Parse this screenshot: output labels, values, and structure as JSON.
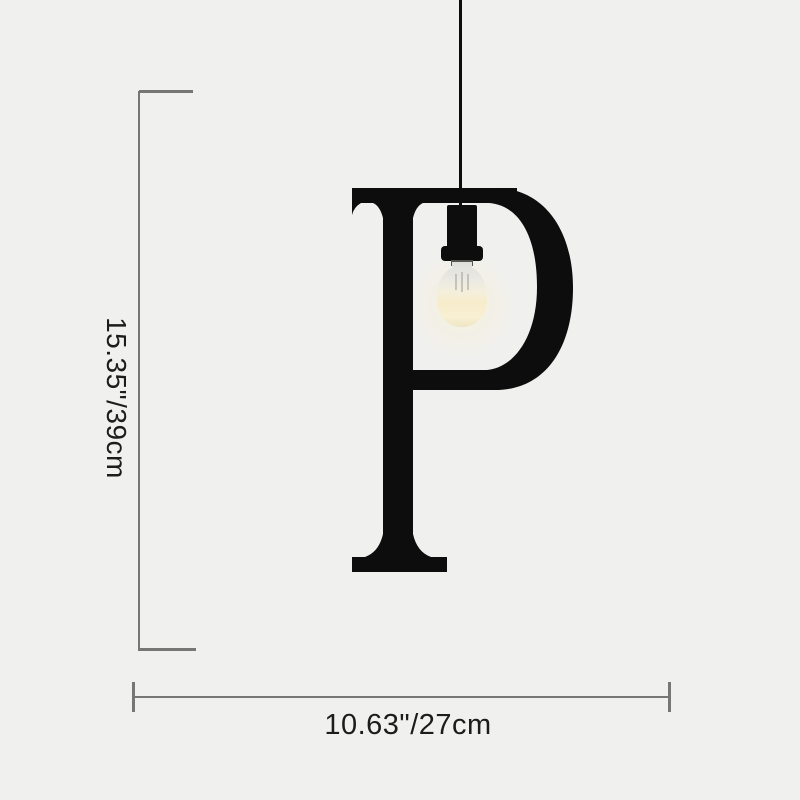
{
  "colors": {
    "bg": "#f0f0ee",
    "ink": "#0d0d0d",
    "dimline": "#767674",
    "dimtext": "#1c1c1c",
    "glow": "#f7eccb"
  },
  "product": {
    "letter": "P"
  },
  "annotations": {
    "height_label": "15.35\"/39cm",
    "width_label": "10.63\"/27cm"
  }
}
